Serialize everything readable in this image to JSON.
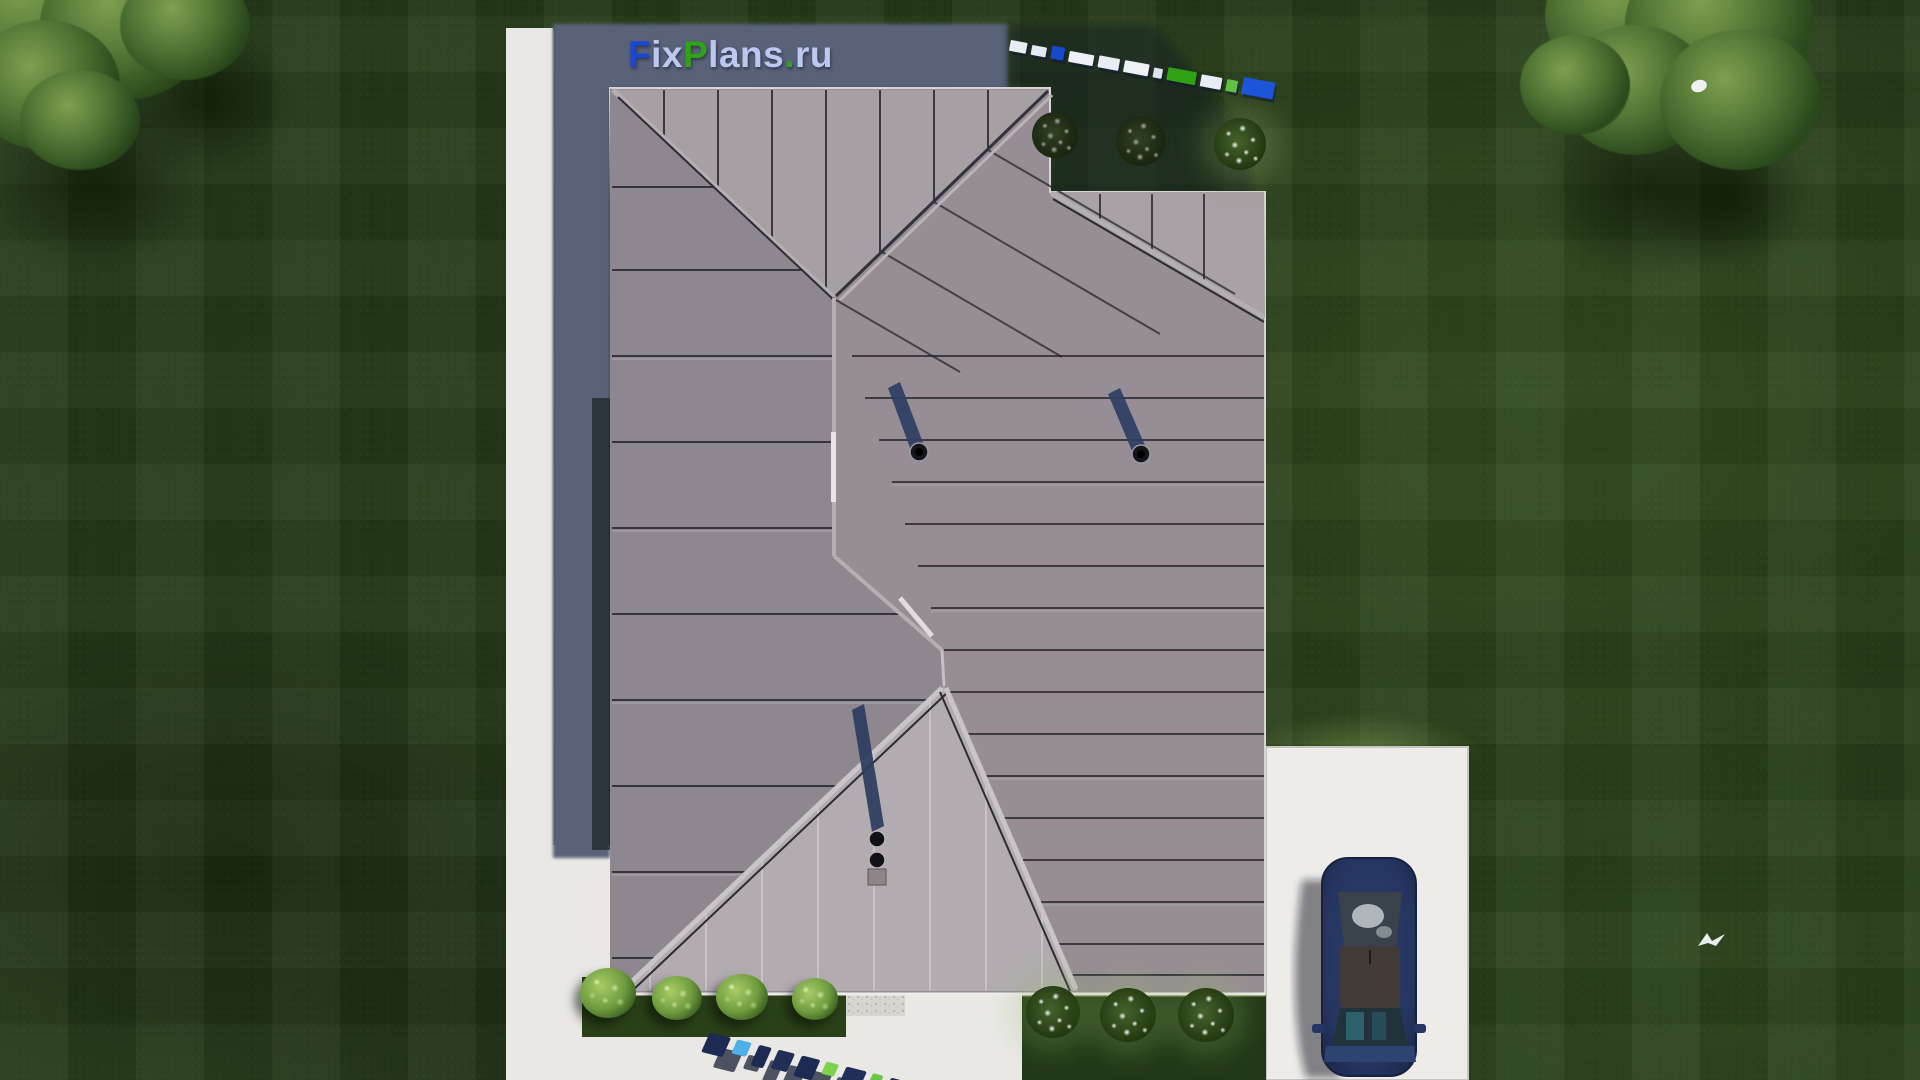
{
  "branding": {
    "logo_text": "FixPlans.ru",
    "logo_letters": [
      {
        "ch": "F",
        "color": "#1a47d4"
      },
      {
        "ch": "i",
        "color": "#bcc8ee"
      },
      {
        "ch": "x",
        "color": "#bcc8ee"
      },
      {
        "ch": "P",
        "color": "#2ea315"
      },
      {
        "ch": "l",
        "color": "#bcc8ee"
      },
      {
        "ch": "a",
        "color": "#bcc8ee"
      },
      {
        "ch": "n",
        "color": "#bcc8ee"
      },
      {
        "ch": "s",
        "color": "#bcc8ee"
      },
      {
        "ch": ".",
        "color": "#2ea315"
      },
      {
        "ch": "r",
        "color": "#bcc8ee"
      },
      {
        "ch": "u",
        "color": "#bcc8ee"
      }
    ]
  },
  "watermarks": {
    "top_right_blocks": [
      {
        "w": 17,
        "h": 11,
        "color": "#e8edf3"
      },
      {
        "w": 15,
        "h": 10,
        "color": "#e4eaf1"
      },
      {
        "w": 13,
        "h": 13,
        "color": "#1747cc"
      },
      {
        "w": 25,
        "h": 11,
        "color": "#eef1f6"
      },
      {
        "w": 21,
        "h": 12,
        "color": "#e8edf3"
      },
      {
        "w": 25,
        "h": 12,
        "color": "#eef1f6"
      },
      {
        "w": 9,
        "h": 10,
        "color": "#dde4eb"
      },
      {
        "w": 29,
        "h": 13,
        "color": "#2fa315"
      },
      {
        "w": 21,
        "h": 12,
        "color": "#e8edf3"
      },
      {
        "w": 11,
        "h": 12,
        "color": "#5fc243"
      },
      {
        "w": 32,
        "h": 17,
        "color": "#1c55d8"
      }
    ],
    "bottom_blocks": [
      {
        "w": 22,
        "h": 21,
        "color": "#1d2a52"
      },
      {
        "w": 15,
        "h": 15,
        "color": "#4fb0e8"
      },
      {
        "w": 13,
        "h": 22,
        "color": "#1d2a52"
      },
      {
        "w": 17,
        "h": 20,
        "color": "#202e58"
      },
      {
        "w": 19,
        "h": 22,
        "color": "#1d2a52"
      },
      {
        "w": 13,
        "h": 13,
        "color": "#7cd24a"
      },
      {
        "w": 21,
        "h": 20,
        "color": "#202e58"
      },
      {
        "w": 11,
        "h": 12,
        "color": "#6cc844"
      },
      {
        "w": 23,
        "h": 20,
        "color": "#1d2a52"
      },
      {
        "w": 19,
        "h": 18,
        "color": "#202e58"
      }
    ]
  },
  "scene": {
    "colors": {
      "lawn": "#253a18",
      "lawn_light": "#52702e",
      "roof_gable": "#b2acb0",
      "roof_east": "#968e94",
      "roof_west": "#8f8790",
      "roof_north": "#a69fa4",
      "roof_seam_dark": "#26262f",
      "house_shadow": "#5a6279",
      "walkway": "#e9e8e5",
      "driveway": "#edece9",
      "gravel": "#d7d6d1",
      "garden_bed": "#2a4118",
      "car_body": "#273760",
      "accent_blue": "#1a47d4",
      "accent_green": "#2ea315"
    },
    "counts": {
      "shrubs": 4,
      "flower_bushes_front": 3,
      "flower_bushes_rear": 3,
      "roof_vents": 3,
      "birds": 2,
      "cars": 1
    }
  }
}
